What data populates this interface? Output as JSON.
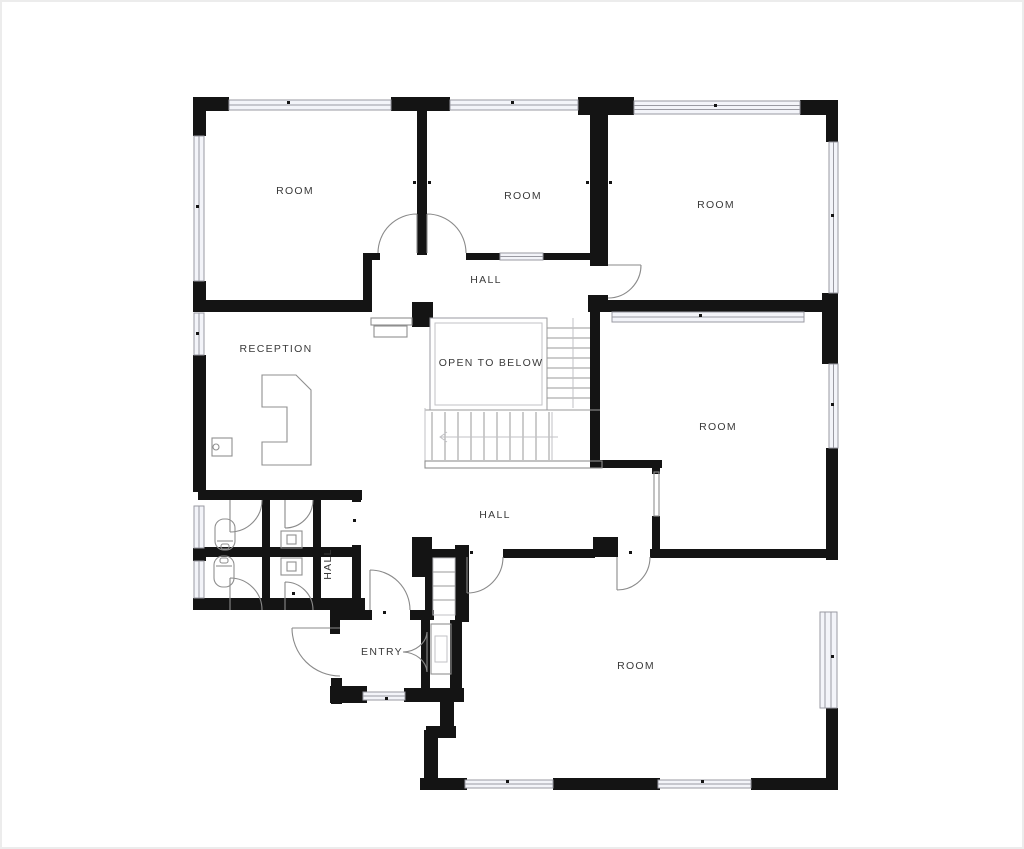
{
  "palette": {
    "wall": "#141414",
    "door_line": "#8a8a8a",
    "window_stroke": "#9a9aa2",
    "window_fill": "#f3f4f9",
    "stair_line": "#9a9a9a",
    "light_line": "#c2c2c6",
    "fixture_line": "#8f8f8f",
    "text": "#3a3a3a",
    "bg": "#ffffff",
    "frame": "#ececec"
  },
  "labels": [
    {
      "id": "room-top-left",
      "text": "ROOM"
    },
    {
      "id": "room-top-middle",
      "text": "ROOM"
    },
    {
      "id": "room-top-right",
      "text": "ROOM"
    },
    {
      "id": "hall-upper",
      "text": "HALL"
    },
    {
      "id": "reception",
      "text": "RECEPTION"
    },
    {
      "id": "open-to-below",
      "text": "OPEN TO BELOW"
    },
    {
      "id": "room-middle-right",
      "text": "ROOM"
    },
    {
      "id": "hall-lower",
      "text": "HALL"
    },
    {
      "id": "hall-wc",
      "text": "HALL"
    },
    {
      "id": "entry",
      "text": "ENTRY"
    },
    {
      "id": "room-bottom",
      "text": "ROOM"
    }
  ]
}
